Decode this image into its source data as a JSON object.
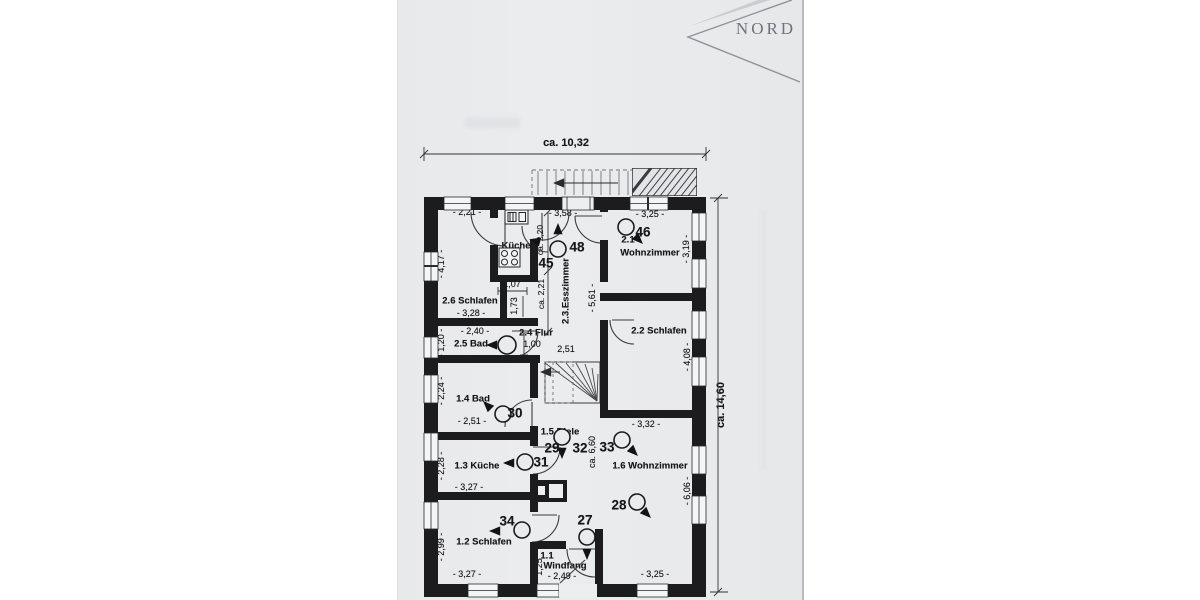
{
  "compass": {
    "label": "NORD"
  },
  "overall": {
    "width": "ca. 10,32",
    "height": "ca. 14,60"
  },
  "upper_floor": {
    "schlafen_2_6": {
      "label": "2.6 Schlafen",
      "dim_top": "- 2,21 -",
      "dim_left": "- 4,17 -",
      "dim_bottom": "- 3,28 -",
      "closet_width": "1,07",
      "closet_depth": "1,73"
    },
    "kueche_2_7": {
      "label": "Küche",
      "dim_depth_upper": "ca. 2,20",
      "dim_depth_lower": "ca. 2,21"
    },
    "esszimmer_2_3": {
      "label": "2.3.Esszimmer",
      "dim_top": "- 3,58 -",
      "dim_right": "- 5,61 -"
    },
    "wohnzimmer_2_1": {
      "number": "2.1",
      "label": "Wohnzimmer",
      "dim_top": "- 3,25 -",
      "dim_right": "- 3,19 -"
    },
    "schlafen_2_2": {
      "label": "2.2 Schlafen",
      "dim_right": "- 4,08 -",
      "dim_bottom": "- 3,32 -"
    },
    "bad_2_5": {
      "label": "2.5 Bad",
      "dim_top": "- 2,40 -",
      "dim_left": "- 1,20 -"
    },
    "flur_2_4": {
      "label": "2.4 Flur",
      "dim_width": "1,00",
      "dim_length": "2,51"
    }
  },
  "ground_floor": {
    "bad_1_4": {
      "label": "1.4 Bad",
      "dim_left": "- 2,24 -",
      "dim_bottom": "- 2,51 -"
    },
    "diele_1_5": {
      "label": "1.5 Diele",
      "dim_length": "ca. 6,60"
    },
    "kueche_1_3": {
      "label": "1.3 Küche",
      "dim_left": "- 2,28 -",
      "dim_bottom": "- 3,27 -"
    },
    "wohnzimmer_1_6": {
      "label": "1.6 Wohnzimmer",
      "dim_right": "- 6,06 -",
      "dim_bottom": "- 3,25 -"
    },
    "schlafen_1_2": {
      "label": "1.2 Schlafen",
      "dim_left": "- 2,99 -",
      "dim_bottom": "- 3,27 -"
    },
    "windfang_1_1": {
      "number": "1.1",
      "label": "Windfang",
      "dim_left": "1,25",
      "dim_bottom": "- 2,49 -"
    }
  },
  "photo_markers": {
    "m27": "27",
    "m28": "28",
    "m29": "29",
    "m30": "30",
    "m31": "31",
    "m32": "32",
    "m33": "33",
    "m34": "34",
    "m45": "45",
    "m46": "46",
    "m48": "48"
  }
}
